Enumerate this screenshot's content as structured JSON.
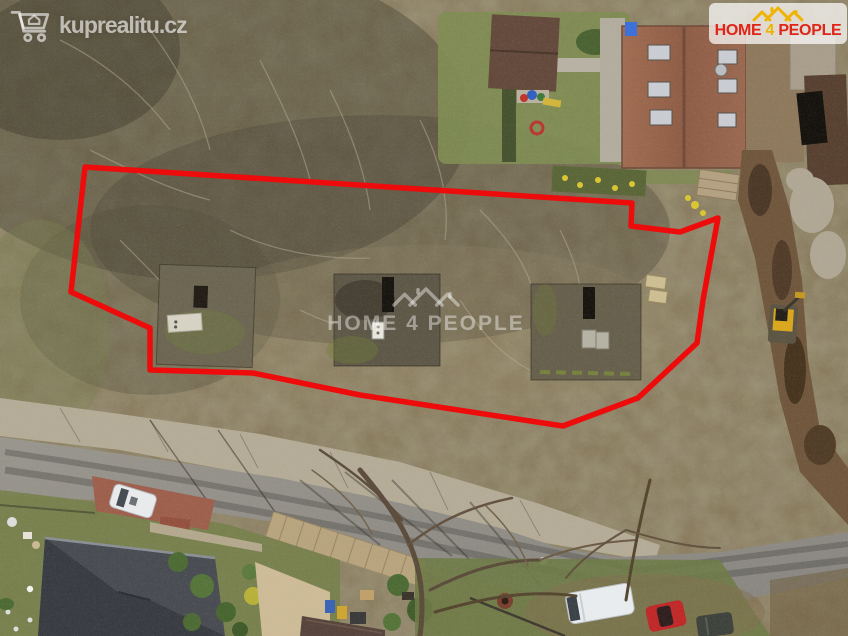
{
  "watermarks": {
    "site_logo": {
      "text": "kuprealitu.cz",
      "icon": "cart-house-icon",
      "color": "rgba(255,255,255,0.62)"
    },
    "agency_badge": {
      "word1": "HOME",
      "word2": "4",
      "word3": "PEOPLE",
      "icon": "triple-rooftops-icon",
      "red": "#e02417",
      "yellow": "#f0b400",
      "background": "rgba(255,255,255,0.72)"
    },
    "center_watermark": {
      "word1": "HOME",
      "word2": "4",
      "word3": "PEOPLE",
      "icon": "triple-rooftops-icon",
      "color": "rgba(255,255,255,0.42)"
    }
  },
  "overlay": {
    "parcel_boundary": {
      "color": "#ee0b0b",
      "stroke_width": "5.5",
      "points": "85,167 632,203 631,226 680,232 718,218 703,300 697,343 638,398 563,426 360,395 253,373 150,370 150,328 71,292"
    }
  }
}
